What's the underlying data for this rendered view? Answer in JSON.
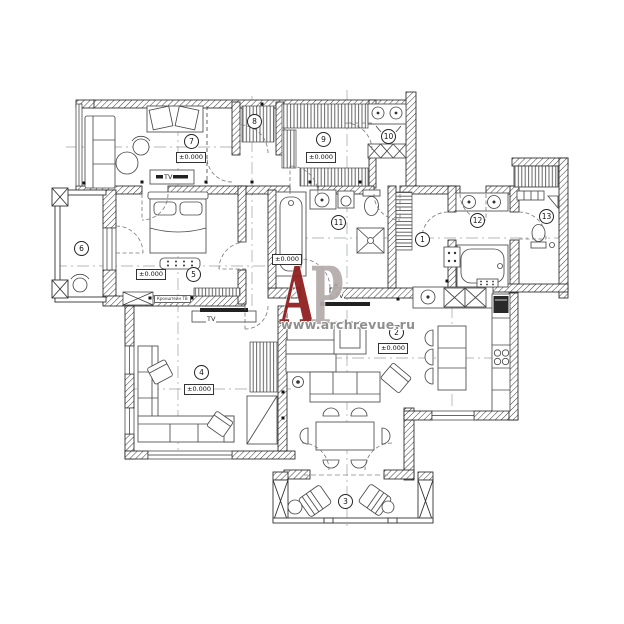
{
  "plan": {
    "rooms": [
      {
        "number": "1"
      },
      {
        "number": "2"
      },
      {
        "number": "3"
      },
      {
        "number": "4"
      },
      {
        "number": "5"
      },
      {
        "number": "6"
      },
      {
        "number": "7"
      },
      {
        "number": "8"
      },
      {
        "number": "9"
      },
      {
        "number": "10"
      },
      {
        "number": "11"
      },
      {
        "number": "12"
      },
      {
        "number": "13"
      }
    ],
    "elevation_label": "±0.000",
    "tv_label": "TV",
    "tv_bracket_label": "Кронштейн ТВ"
  },
  "watermark": {
    "letter_a": "А",
    "letter_p": "Р",
    "site": "www.archrevue.ru",
    "letter_a_color": "#8e1c1c",
    "letter_p_color": "#b4abab",
    "site_color": "#8f8f8f"
  },
  "colors": {
    "background": "#ffffff",
    "line": "#1a1a1a"
  }
}
